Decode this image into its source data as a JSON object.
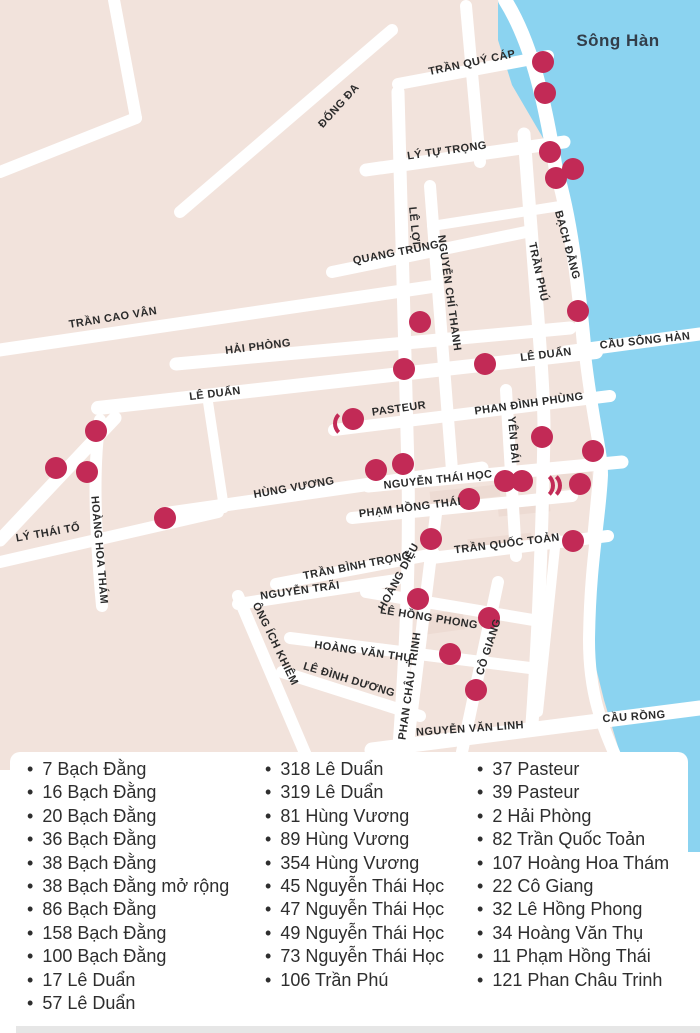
{
  "colors": {
    "land": "#f2e3dc",
    "block": "#ecd9d0",
    "road": "#ffffff",
    "water": "#8bd3f0",
    "marker": "#c22a56",
    "street_text": "#2b2b2b",
    "water_text": "#333e4a",
    "list_text": "#2e2e2e",
    "bottom_strip": "#e6e6e6"
  },
  "map": {
    "water_label": "Sông Hàn",
    "marker_radius": 11,
    "streets": [
      {
        "label": "TRẦN QUÝ CÁP",
        "x": 472,
        "y": 63,
        "r": -12
      },
      {
        "label": "Sông Hàn",
        "x": 618,
        "y": 41,
        "r": 0,
        "kind": "water"
      },
      {
        "label": "ĐỐNG ĐA",
        "x": 339,
        "y": 106,
        "r": -48
      },
      {
        "label": "LÝ TỰ TRỌNG",
        "x": 447,
        "y": 151,
        "r": -8
      },
      {
        "label": "LÊ LỢI",
        "x": 414,
        "y": 226,
        "r": 84
      },
      {
        "label": "QUANG TRUNG",
        "x": 396,
        "y": 253,
        "r": -11
      },
      {
        "label": "NGUYỄN CHÍ THANH",
        "x": 449,
        "y": 293,
        "r": 82
      },
      {
        "label": "TRẦN PHÚ",
        "x": 538,
        "y": 272,
        "r": 78
      },
      {
        "label": "BẠCH ĐẰNG",
        "x": 567,
        "y": 245,
        "r": 75
      },
      {
        "label": "TRẦN CAO VÂN",
        "x": 113,
        "y": 318,
        "r": -9
      },
      {
        "label": "HẢI PHÒNG",
        "x": 258,
        "y": 347,
        "r": -7
      },
      {
        "label": "LÊ DUẨN",
        "x": 546,
        "y": 355,
        "r": -7
      },
      {
        "label": "CẦU SÔNG HÀN",
        "x": 645,
        "y": 341,
        "r": -6
      },
      {
        "label": "LÊ DUẨN",
        "x": 215,
        "y": 394,
        "r": -7
      },
      {
        "label": "PASTEUR",
        "x": 399,
        "y": 409,
        "r": -8
      },
      {
        "label": "PHAN ĐÌNH PHÙNG",
        "x": 529,
        "y": 404,
        "r": -8
      },
      {
        "label": "YÊN BÁI",
        "x": 513,
        "y": 440,
        "r": 85
      },
      {
        "label": "HÙNG VƯƠNG",
        "x": 294,
        "y": 488,
        "r": -10
      },
      {
        "label": "NGUYỄN THÁI HỌC",
        "x": 438,
        "y": 480,
        "r": -6
      },
      {
        "label": "PHẠM HỒNG THÁI",
        "x": 410,
        "y": 508,
        "r": -7
      },
      {
        "label": "LÝ THÁI TỔ",
        "x": 48,
        "y": 533,
        "r": -10
      },
      {
        "label": "HOÀNG HOA THÁM",
        "x": 99,
        "y": 550,
        "r": 85
      },
      {
        "label": "TRẦN BÌNH TRỌNG",
        "x": 357,
        "y": 566,
        "r": -11
      },
      {
        "label": "TRẦN QUỐC TOẢN",
        "x": 507,
        "y": 544,
        "r": -7
      },
      {
        "label": "NGUYỄN TRÃI",
        "x": 300,
        "y": 591,
        "r": -8
      },
      {
        "label": "HOÀNG DIỆU",
        "x": 399,
        "y": 577,
        "r": -62
      },
      {
        "label": "ÔNG ÍCH KHIÊM",
        "x": 275,
        "y": 644,
        "r": 64
      },
      {
        "label": "LÊ HỒNG PHONG",
        "x": 429,
        "y": 618,
        "r": 9
      },
      {
        "label": "HOÀNG VĂN THỤ",
        "x": 363,
        "y": 652,
        "r": 8
      },
      {
        "label": "PHAN CHÂU TRINH",
        "x": 410,
        "y": 686,
        "r": -82
      },
      {
        "label": "CÔ GIANG",
        "x": 489,
        "y": 647,
        "r": -72
      },
      {
        "label": "LÊ ĐÌNH DƯƠNG",
        "x": 349,
        "y": 680,
        "r": 17
      },
      {
        "label": "NGUYỄN VĂN LINH",
        "x": 470,
        "y": 729,
        "r": -4
      },
      {
        "label": "CẦU RỒNG",
        "x": 634,
        "y": 717,
        "r": -4
      }
    ],
    "markers": [
      [
        543,
        62
      ],
      [
        545,
        93
      ],
      [
        550,
        152
      ],
      [
        573,
        169
      ],
      [
        556,
        178
      ],
      [
        578,
        311
      ],
      [
        420,
        322
      ],
      [
        404,
        369
      ],
      [
        485,
        364
      ],
      [
        353,
        419
      ],
      [
        542,
        437
      ],
      [
        593,
        451
      ],
      [
        96,
        431
      ],
      [
        56,
        468
      ],
      [
        87,
        472
      ],
      [
        165,
        518
      ],
      [
        376,
        470
      ],
      [
        403,
        464
      ],
      [
        505,
        481
      ],
      [
        522,
        481
      ],
      [
        580,
        484
      ],
      [
        469,
        499
      ],
      [
        431,
        539
      ],
      [
        573,
        541
      ],
      [
        418,
        599
      ],
      [
        489,
        618
      ],
      [
        450,
        654
      ],
      [
        476,
        690
      ]
    ],
    "marker_arcs": [
      {
        "x": 536,
        "y": 481,
        "dir": "right"
      },
      {
        "x": 543,
        "y": 481,
        "dir": "right"
      },
      {
        "x": 343,
        "y": 419,
        "dir": "left"
      }
    ]
  },
  "address_list": {
    "columns": [
      {
        "items": [
          "7 Bạch Đằng",
          "16 Bạch Đằng",
          "20 Bạch Đằng",
          "36 Bạch Đằng",
          "38 Bạch Đằng",
          "38 Bạch Đằng mở rộng",
          "86 Bạch Đằng",
          "158 Bạch Đằng",
          "100 Bạch Đằng",
          "17 Lê Duẩn",
          "57 Lê Duẩn"
        ]
      },
      {
        "items": [
          "318 Lê Duẩn",
          "319 Lê Duẩn",
          "81 Hùng Vương",
          "89 Hùng Vương",
          "354 Hùng Vương",
          "45 Nguyễn Thái Học",
          "47 Nguyễn Thái Học",
          "49 Nguyễn Thái Học",
          "73 Nguyễn Thái Học",
          "106 Trần Phú"
        ]
      },
      {
        "items": [
          "37 Pasteur",
          "39 Pasteur",
          "2 Hải Phòng",
          "82 Trần Quốc Toản",
          "107 Hoàng Hoa Thám",
          "22 Cô Giang",
          "32 Lê Hồng Phong",
          "34 Hoàng Văn Thụ",
          "11 Phạm Hồng Thái",
          "121 Phan Châu Trinh"
        ]
      }
    ]
  }
}
